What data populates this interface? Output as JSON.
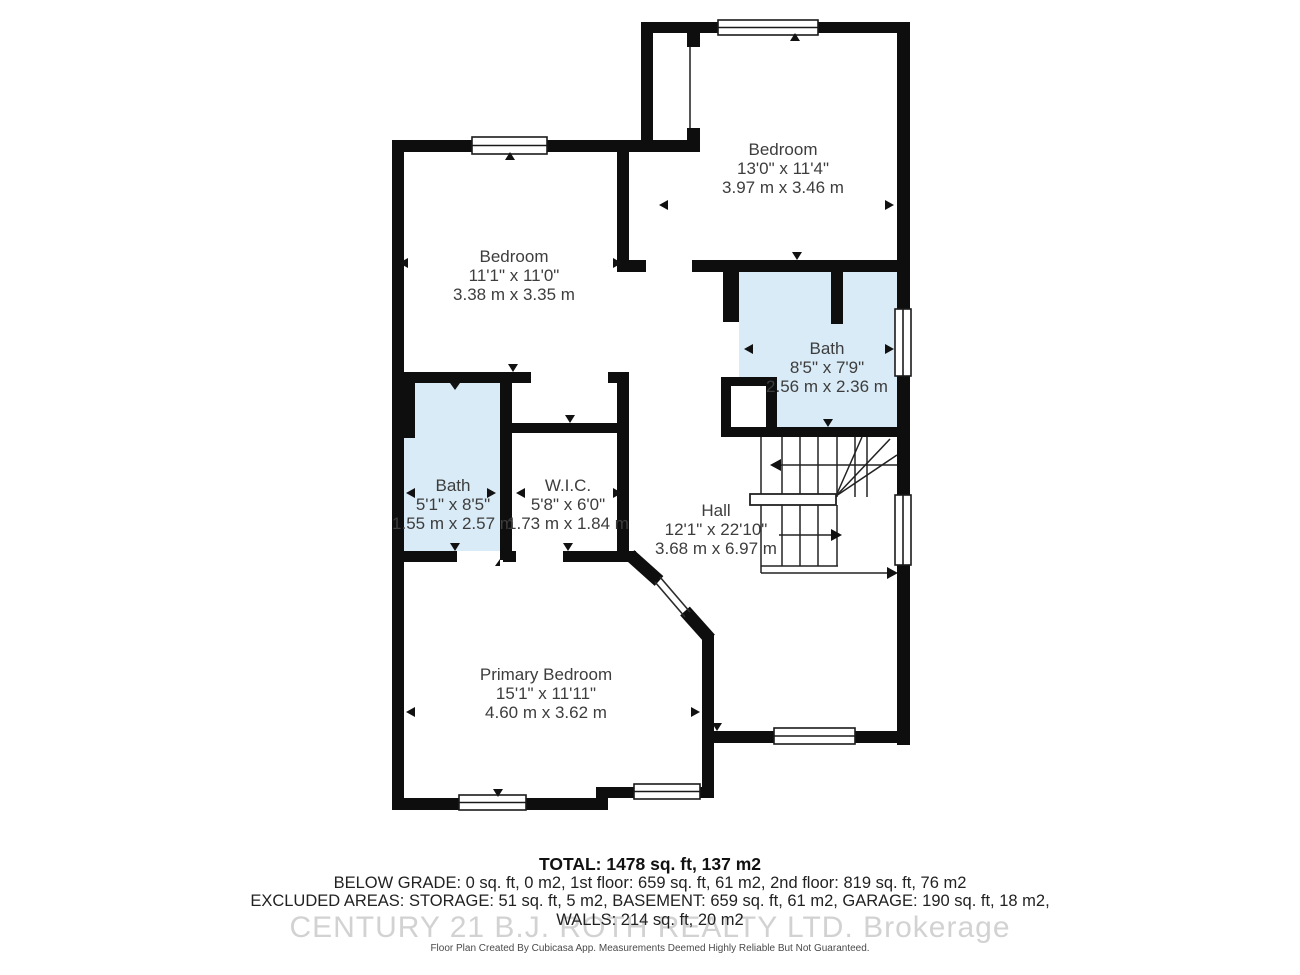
{
  "rooms": {
    "bedroom_top": {
      "name": "Bedroom",
      "imperial": "13'0\" x 11'4\"",
      "metric": "3.97 m x 3.46 m"
    },
    "bedroom_left": {
      "name": "Bedroom",
      "imperial": "11'1\" x 11'0\"",
      "metric": "3.38 m x 3.35 m"
    },
    "bath_right": {
      "name": "Bath",
      "imperial": "8'5\" x 7'9\"",
      "metric": "2.56 m x 2.36 m"
    },
    "bath_left": {
      "name": "Bath",
      "imperial": "5'1\" x 8'5\"",
      "metric": "1.55 m x 2.57 m"
    },
    "wic": {
      "name": "W.I.C.",
      "imperial": "5'8\" x 6'0\"",
      "metric": "1.73 m x 1.84 m"
    },
    "hall": {
      "name": "Hall",
      "imperial": "12'1\" x 22'10\"",
      "metric": "3.68 m x 6.97 m"
    },
    "primary": {
      "name": "Primary Bedroom",
      "imperial": "15'1\" x 11'11\"",
      "metric": "4.60 m x 3.62 m"
    }
  },
  "summary": {
    "total": "TOTAL: 1478 sq. ft, 137 m2",
    "line1": "BELOW GRADE: 0 sq. ft, 0 m2, 1st floor: 659 sq. ft, 61 m2, 2nd floor: 819 sq. ft, 76 m2",
    "line2": "EXCLUDED AREAS: STORAGE: 51 sq. ft, 5 m2, BASEMENT: 659 sq. ft, 61 m2, GARAGE: 190 sq. ft, 18 m2,",
    "line3": "WALLS: 214 sq. ft, 20 m2"
  },
  "watermark": "CENTURY 21 B.J. ROTH REALTY LTD.  Brokerage",
  "disclaimer": "Floor Plan Created By Cubicasa App. Measurements Deemed Highly Reliable But Not Guaranteed.",
  "colors": {
    "wall": "#0e0e0e",
    "room_highlight": "#d9ebf7",
    "label_text": "#3d3d3d",
    "watermark": "#d2d2d2",
    "stair_line": "#222222"
  }
}
